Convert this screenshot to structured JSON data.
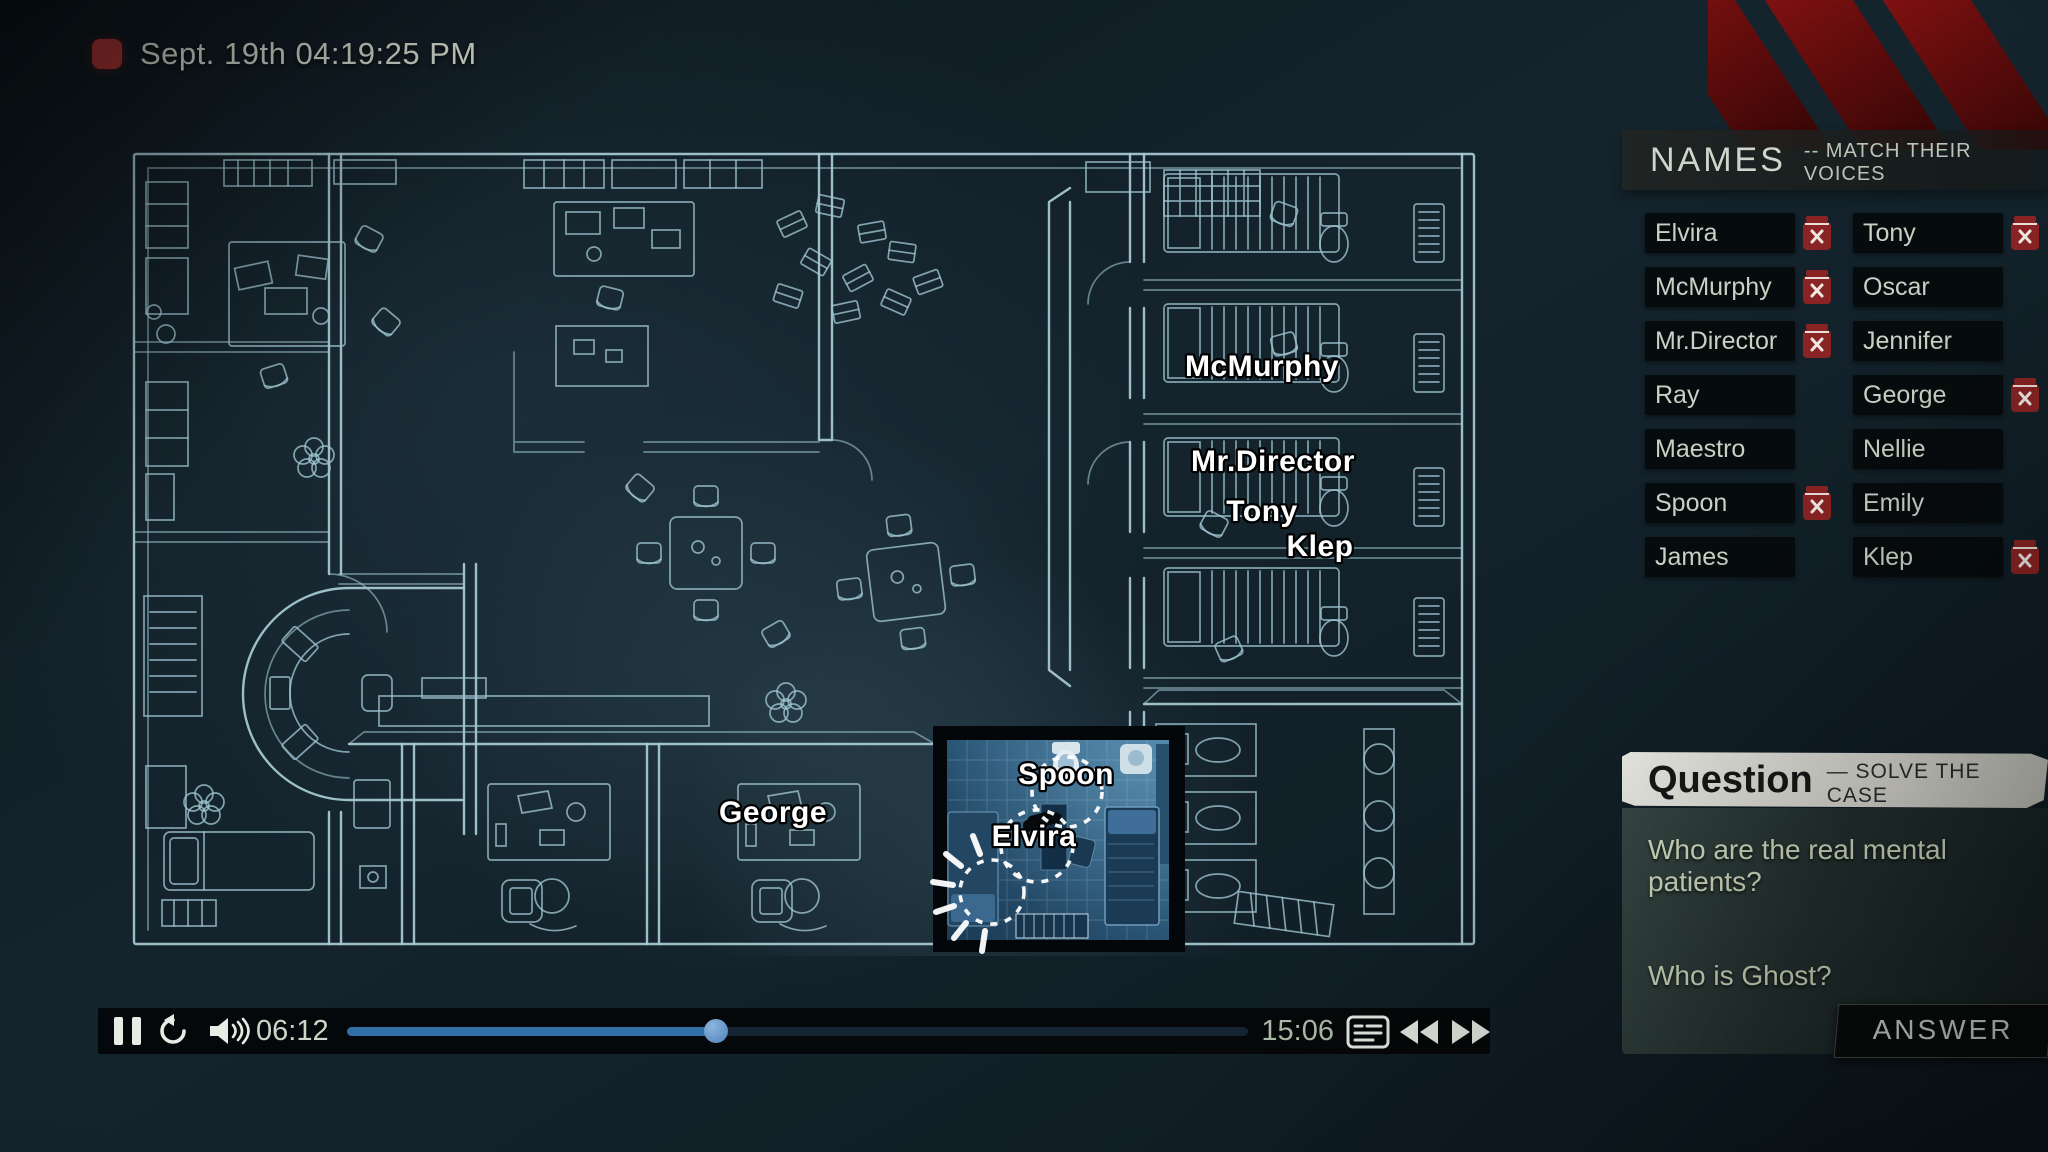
{
  "recorder": {
    "timestamp": "Sept. 19th 04:19:25 PM"
  },
  "names_panel": {
    "title": "NAMES",
    "subtitle": "-- MATCH THEIR VOICES",
    "entries": [
      {
        "name": "Elvira",
        "removable": true
      },
      {
        "name": "Tony",
        "removable": true
      },
      {
        "name": "McMurphy",
        "removable": true
      },
      {
        "name": "Oscar",
        "removable": false
      },
      {
        "name": "Mr.Director",
        "removable": true
      },
      {
        "name": "Jennifer",
        "removable": false
      },
      {
        "name": "Ray",
        "removable": false
      },
      {
        "name": "George",
        "removable": true
      },
      {
        "name": "Maestro",
        "removable": false
      },
      {
        "name": "Nellie",
        "removable": false
      },
      {
        "name": "Spoon",
        "removable": true
      },
      {
        "name": "Emily",
        "removable": false
      },
      {
        "name": "James",
        "removable": false
      },
      {
        "name": "Klep",
        "removable": true
      }
    ]
  },
  "map": {
    "labels": {
      "mcmurphy": "McMurphy",
      "mr_director": "Mr.Director",
      "tony": "Tony",
      "klep": "Klep",
      "george": "George",
      "spoon": "Spoon",
      "elvira": "Elvira"
    }
  },
  "question_panel": {
    "title": "Question",
    "subtitle": "— SOLVE THE CASE",
    "questions": {
      "q1": "Who are the real mental patients?",
      "q2": "Who is Ghost?"
    }
  },
  "answer_button": {
    "label": "ANSWER"
  },
  "player": {
    "elapsed": "06:12",
    "total": "15:06",
    "progress_left": "41%"
  },
  "colors": {
    "accent_red": "#8a2323",
    "blueprint_line": "#a9ccd6",
    "progress_blue": "#2f6ea6"
  }
}
